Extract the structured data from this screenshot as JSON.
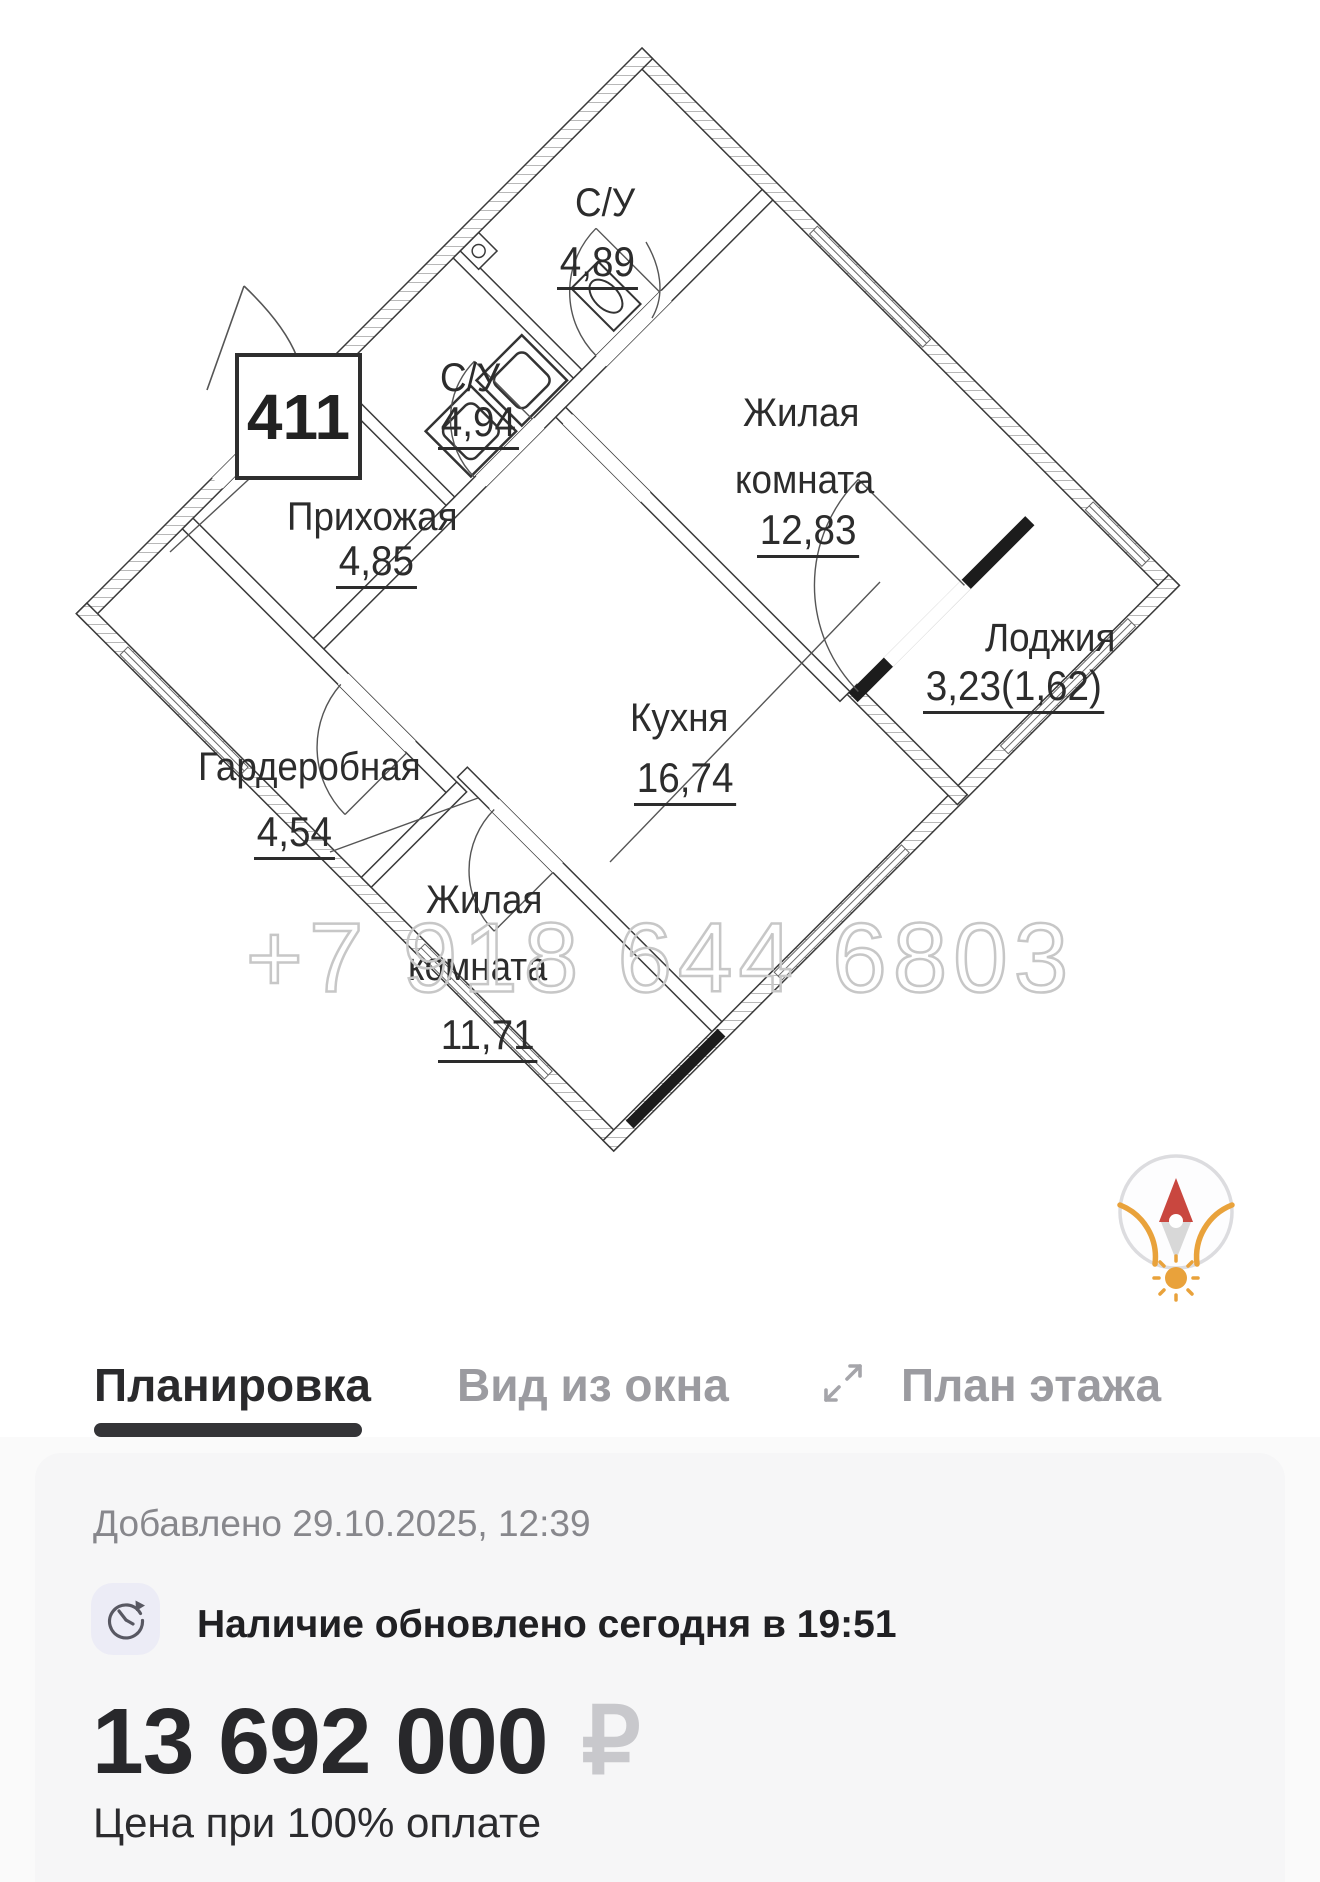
{
  "floor_plan": {
    "apartment_number": "411",
    "watermark": "+7 918 644 6803",
    "rooms": [
      {
        "name": "С/У",
        "area": "4,89"
      },
      {
        "name": "С/У",
        "area": "4,94"
      },
      {
        "name": "Жилая",
        "name2": "комната",
        "area": "12,83"
      },
      {
        "name": "Прихожая",
        "area": "4,85"
      },
      {
        "name": "Лоджия",
        "area": "3,23(1,62)"
      },
      {
        "name": "Кухня",
        "area": "16,74"
      },
      {
        "name": "Гардеробная",
        "area": "4,54"
      },
      {
        "name": "Жилая",
        "name2": "комната",
        "area": "11,71"
      }
    ],
    "compass": {
      "north_color": "#c9473f",
      "tail_color": "#d8d8d8",
      "ring_color": "#dcdcdf",
      "sun_color": "#e9a23b"
    }
  },
  "tabs": [
    {
      "label": "Планировка",
      "active": true
    },
    {
      "label": "Вид из окна",
      "active": false
    },
    {
      "label": "План этажа",
      "active": false
    }
  ],
  "details": {
    "added_label": "Добавлено 29.10.2025, 12:39",
    "availability": "Наличие обновлено сегодня в 19:51",
    "price": "13 692 000",
    "currency": "₽",
    "price_note": "Цена при 100% оплате"
  },
  "colors": {
    "plan_line": "#3a3a3a",
    "tab_active": "#2a2a2c",
    "tab_inactive": "#9b9ba0",
    "card_bg": "#f6f6f7",
    "icon_bg": "#ececf6",
    "muted_text": "#87878c",
    "currency_gray": "#c8c8cc",
    "watermark_gray": "#c7c7c7"
  }
}
